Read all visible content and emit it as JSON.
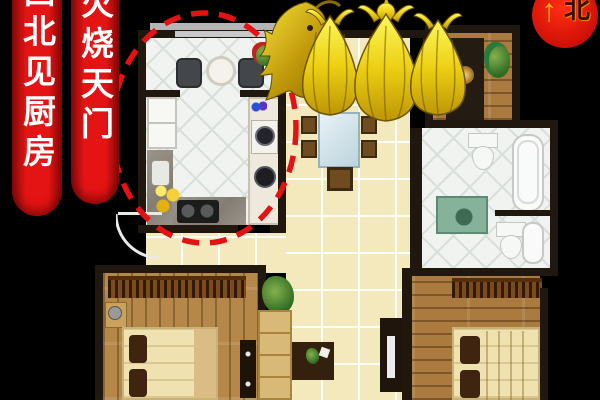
{
  "banners": {
    "first": {
      "text": "西北见厨房"
    },
    "second": {
      "text": "火烧天门"
    }
  },
  "compass": {
    "label": "北",
    "arrow_glyph": "↑"
  },
  "icons": {
    "dragon": "golden-dragon-statue",
    "money_bag": "golden-money-bag",
    "highlight": "red-dashed-ellipse",
    "north_arrow": "up-arrow"
  },
  "palette": {
    "background": "#000000",
    "banner_red": "#e51414",
    "banner_text": "#ffffff",
    "compass_red": "#d60b06",
    "compass_arrow": "#f6ae00",
    "gold": "#edd012",
    "gold_dark": "#8a6c04",
    "wall": "#20170e",
    "tile_cream": "#f4e9bd",
    "tile_white": "#f0f3ef",
    "wood": "#ab7a3e",
    "highlight_red": "#e41212"
  }
}
